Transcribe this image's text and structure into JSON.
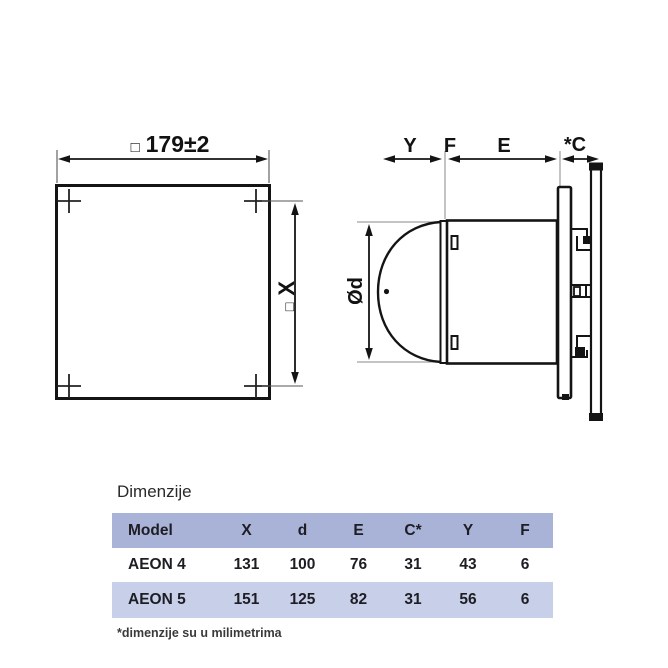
{
  "drawing": {
    "front_view": {
      "square_symbol": "□",
      "width_value": "179±2",
      "height_symbol": "□",
      "height_label": "X"
    },
    "side_view": {
      "dim_y": "Y",
      "dim_f": "F",
      "dim_e": "E",
      "dim_c": "*C",
      "dim_diameter": "Ød"
    }
  },
  "section": {
    "title": "Dimenzije",
    "footnote": "*dimenzije su u milimetrima"
  },
  "table": {
    "columns": [
      "Model",
      "X",
      "d",
      "E",
      "C*",
      "Y",
      "F"
    ],
    "rows": [
      {
        "model": "AEON 4",
        "x": "131",
        "d": "100",
        "e": "76",
        "c": "31",
        "y": "43",
        "f": "6"
      },
      {
        "model": "AEON 5",
        "x": "151",
        "d": "125",
        "e": "82",
        "c": "31",
        "y": "56",
        "f": "6"
      }
    ]
  },
  "colors": {
    "table_header_bg": "#a9b3d7",
    "table_row_alt_bg": "#c8cfe9",
    "drawing_line": "#141414"
  }
}
